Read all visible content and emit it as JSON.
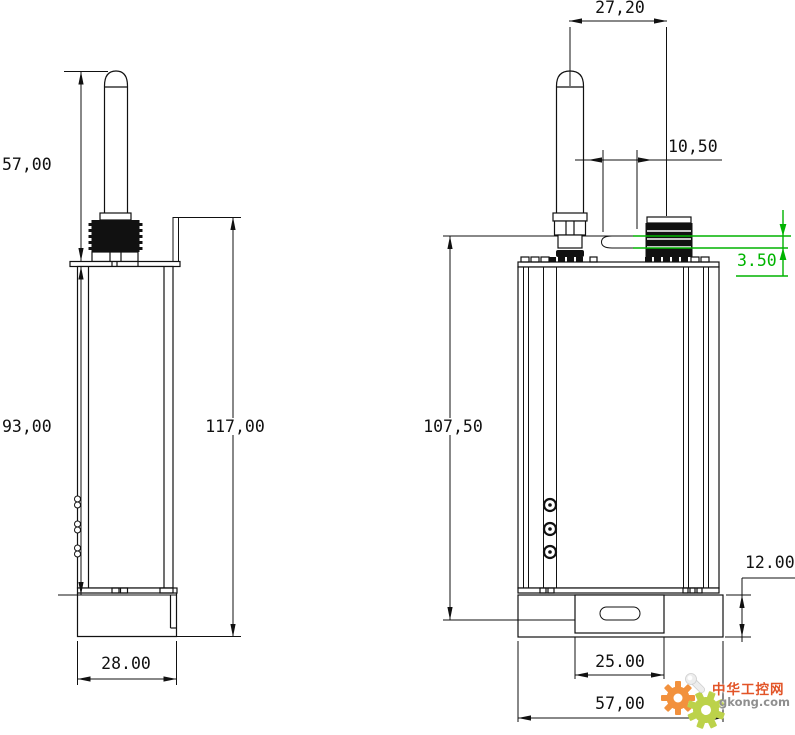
{
  "drawing": {
    "type": "technical-outline-drawing",
    "views": [
      "side-view",
      "front-view"
    ],
    "units_style": "millimeters",
    "line_color": "#111111",
    "highlight_color": "#00b400"
  },
  "dimensions": {
    "left_view": {
      "antenna_height": "57,00",
      "body_height": "93,00",
      "overall_height": "117,00",
      "body_depth": "28.00"
    },
    "right_view": {
      "antenna_to_connector": "27,20",
      "slot_width": "10,50",
      "rim_offset": "3.50",
      "body_height": "107,50",
      "flange_height": "12.00",
      "mount_slot_span": "25.00",
      "body_width": "57,00"
    }
  },
  "watermark": {
    "site_name": "中华工控网",
    "site_url": "gkong.com",
    "gear_orange": "#f2913d",
    "gear_green": "#bcd24a"
  }
}
